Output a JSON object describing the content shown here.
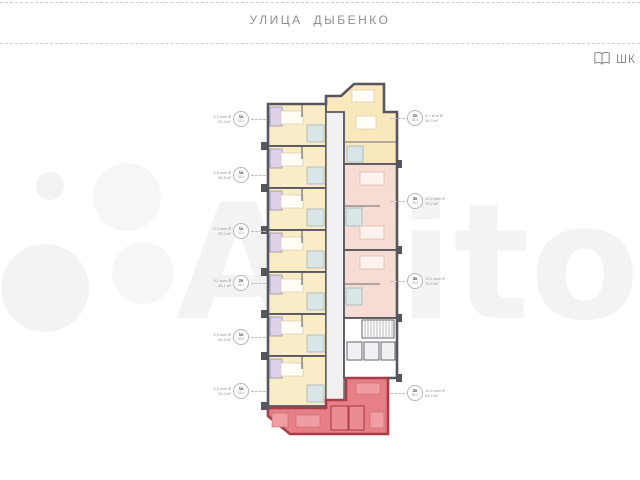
{
  "header": {
    "street": "УЛИЦА ДЫБЕНКО",
    "school_label": "ШК"
  },
  "watermark": {
    "text": "Avito"
  },
  "plan": {
    "left_units": [
      {
        "rooms": "1к",
        "area": "32,4",
        "price": "6,2 млн ₽"
      },
      {
        "rooms": "1к",
        "area": "36,8",
        "price": "6,8 млн ₽"
      },
      {
        "rooms": "1к",
        "area": "32,4",
        "price": "6,3 млн ₽"
      },
      {
        "rooms": "2к",
        "area": "45,1",
        "price": "8,1 млн ₽"
      },
      {
        "rooms": "1к",
        "area": "36,8",
        "price": "6,9 млн ₽"
      },
      {
        "rooms": "1к",
        "area": "34,0",
        "price": "6,5 млн ₽"
      }
    ],
    "right_units": [
      {
        "rooms": "2к",
        "area": "58,3",
        "price": "9,7 млн ₽"
      },
      {
        "rooms": "3к",
        "area": "78,2",
        "price": "12,4 млн ₽"
      },
      {
        "rooms": "3к",
        "area": "76,5",
        "price": "12,1 млн ₽"
      },
      {
        "rooms": "2к",
        "area": "64,9",
        "price": "10,8 млн ₽"
      }
    ],
    "colors": {
      "walls": "#56565e",
      "unit_yellow": "#faecc6",
      "unit_yellow_top": "#f8e8bc",
      "unit_pink": "#f6dcd3",
      "unit_selected_fill": "#e67f86",
      "unit_selected_wall": "#a93c47",
      "bathroom_purple": "#ded2ea",
      "wet_zone_blue": "#d9e5e7",
      "corridor": "#f1f1f3"
    }
  }
}
